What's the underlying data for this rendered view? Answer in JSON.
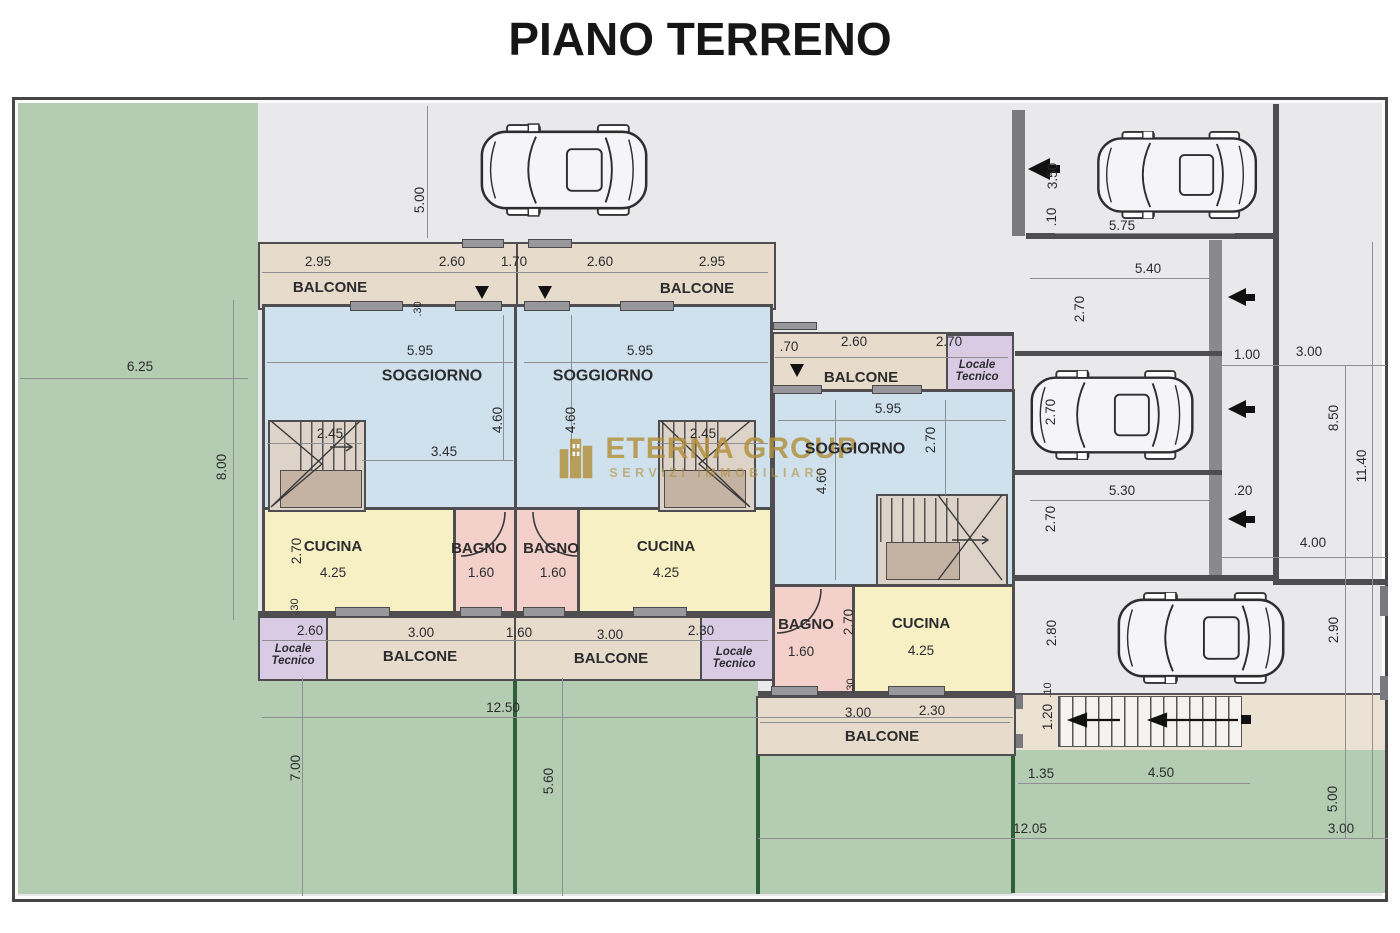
{
  "title": "PIANO TERRENO",
  "watermark": {
    "name": "ETERNA GROUP",
    "tagline": "SERVIZI IMMOBILIARI"
  },
  "colors": {
    "wall": "#4e4e50",
    "drive": "#e9e9ec",
    "garden": "#b3ccb2",
    "gardenDark": "#2f5e38",
    "soggiorno": "#cfe1ed",
    "cucina": "#f7f0c5",
    "bagno": "#f3d1ca",
    "balcone": "#e7dccb",
    "locale": "#d9cbe4",
    "stairs": "#ddd3c8",
    "landing": "#c4b3a3",
    "ramp": "#ece2d4",
    "wm": "#b3903c"
  },
  "icons": {
    "car": "car-top-view-icon",
    "entrance_arrow": "arrow-left-icon",
    "door_arrow": "arrow-down-icon",
    "logo": "buildings-logo-icon"
  },
  "labels": [
    {
      "t": "5.00",
      "x": 420,
      "y": 200,
      "r": 1
    },
    {
      "t": "2.95",
      "x": 318,
      "y": 262
    },
    {
      "t": "2.60",
      "x": 452,
      "y": 262
    },
    {
      "t": "1.70",
      "x": 514,
      "y": 262
    },
    {
      "t": "2.60",
      "x": 600,
      "y": 262
    },
    {
      "t": "2.95",
      "x": 712,
      "y": 262
    },
    {
      "t": "BALCONE",
      "x": 330,
      "y": 288,
      "b": 1,
      "s": 15
    },
    {
      "t": "BALCONE",
      "x": 697,
      "y": 289,
      "b": 1,
      "s": 15
    },
    {
      "t": ".30",
      "x": 419,
      "y": 309,
      "r": 1,
      "s": 11
    },
    {
      "t": "5.95",
      "x": 420,
      "y": 351
    },
    {
      "t": "SOGGIORNO",
      "x": 432,
      "y": 377,
      "b": 1,
      "s": 16
    },
    {
      "t": "2.45",
      "x": 330,
      "y": 434
    },
    {
      "t": "4.60",
      "x": 498,
      "y": 420,
      "r": 1
    },
    {
      "t": "3.45",
      "x": 444,
      "y": 452
    },
    {
      "t": "5.95",
      "x": 640,
      "y": 351
    },
    {
      "t": "SOGGIORNO",
      "x": 603,
      "y": 377,
      "b": 1,
      "s": 16
    },
    {
      "t": "2.45",
      "x": 703,
      "y": 434
    },
    {
      "t": "4.60",
      "x": 571,
      "y": 420,
      "r": 1
    },
    {
      "t": "2.70",
      "x": 297,
      "y": 551,
      "r": 1
    },
    {
      "t": "CUCINA",
      "x": 333,
      "y": 547,
      "b": 1,
      "s": 15
    },
    {
      "t": "4.25",
      "x": 333,
      "y": 573
    },
    {
      "t": "BAGNO",
      "x": 479,
      "y": 549,
      "b": 1,
      "s": 15
    },
    {
      "t": "1.60",
      "x": 481,
      "y": 573
    },
    {
      "t": "BAGNO",
      "x": 551,
      "y": 549,
      "b": 1,
      "s": 15
    },
    {
      "t": "1.60",
      "x": 553,
      "y": 573
    },
    {
      "t": "CUCINA",
      "x": 666,
      "y": 547,
      "b": 1,
      "s": 15
    },
    {
      "t": "4.25",
      "x": 666,
      "y": 573
    },
    {
      "t": ".30",
      "x": 296,
      "y": 606,
      "r": 1,
      "s": 11
    },
    {
      "t": "2.60",
      "x": 310,
      "y": 631
    },
    {
      "t": "3.00",
      "x": 421,
      "y": 633
    },
    {
      "t": "1.60",
      "x": 519,
      "y": 633
    },
    {
      "t": "3.00",
      "x": 610,
      "y": 635
    },
    {
      "t": "2.30",
      "x": 701,
      "y": 631
    },
    {
      "t": "Locale\nTecnico",
      "x": 293,
      "y": 655,
      "i": 1,
      "b": 1,
      "s": 11.5
    },
    {
      "t": "BALCONE",
      "x": 420,
      "y": 657,
      "b": 1,
      "s": 15
    },
    {
      "t": "BALCONE",
      "x": 611,
      "y": 659,
      "b": 1,
      "s": 15
    },
    {
      "t": "Locale\nTecnico",
      "x": 734,
      "y": 658,
      "i": 1,
      "b": 1,
      "s": 11.5
    },
    {
      "t": "12.50",
      "x": 503,
      "y": 708
    },
    {
      "t": "6.25",
      "x": 140,
      "y": 367
    },
    {
      "t": "8.00",
      "x": 222,
      "y": 467,
      "r": 1
    },
    {
      "t": "7.00",
      "x": 296,
      "y": 768,
      "r": 1
    },
    {
      "t": "5.60",
      "x": 549,
      "y": 781,
      "r": 1
    },
    {
      "t": ".70",
      "x": 789,
      "y": 347
    },
    {
      "t": "2.60",
      "x": 854,
      "y": 342
    },
    {
      "t": "2.70",
      "x": 949,
      "y": 342
    },
    {
      "t": "BALCONE",
      "x": 861,
      "y": 378,
      "b": 1,
      "s": 15
    },
    {
      "t": "Locale\nTecnico",
      "x": 977,
      "y": 371,
      "i": 1,
      "b": 1,
      "s": 11.5
    },
    {
      "t": "5.95",
      "x": 888,
      "y": 409
    },
    {
      "t": "SOGGIORNO",
      "x": 855,
      "y": 450,
      "b": 1,
      "s": 16
    },
    {
      "t": "2.70",
      "x": 931,
      "y": 440,
      "r": 1
    },
    {
      "t": "4.60",
      "x": 822,
      "y": 481,
      "r": 1
    },
    {
      "t": "BAGNO",
      "x": 806,
      "y": 625,
      "b": 1,
      "s": 15
    },
    {
      "t": "1.60",
      "x": 801,
      "y": 652
    },
    {
      "t": "2.70",
      "x": 849,
      "y": 622,
      "r": 1
    },
    {
      "t": "CUCINA",
      "x": 921,
      "y": 624,
      "b": 1,
      "s": 15
    },
    {
      "t": "4.25",
      "x": 921,
      "y": 651
    },
    {
      "t": ".30",
      "x": 852,
      "y": 686,
      "r": 1,
      "s": 11
    },
    {
      "t": "3.00",
      "x": 858,
      "y": 713
    },
    {
      "t": "2.30",
      "x": 932,
      "y": 711
    },
    {
      "t": "BALCONE",
      "x": 882,
      "y": 737,
      "b": 1,
      "s": 15
    },
    {
      "t": "3.50",
      "x": 1053,
      "y": 176,
      "r": 1
    },
    {
      "t": ".10",
      "x": 1052,
      "y": 217,
      "r": 1
    },
    {
      "t": "5.75",
      "x": 1122,
      "y": 226
    },
    {
      "t": "5.40",
      "x": 1148,
      "y": 269
    },
    {
      "t": "2.70",
      "x": 1080,
      "y": 309,
      "r": 1
    },
    {
      "t": "1.00",
      "x": 1247,
      "y": 355
    },
    {
      "t": "3.00",
      "x": 1309,
      "y": 352
    },
    {
      "t": "2.70",
      "x": 1051,
      "y": 412,
      "r": 1
    },
    {
      "t": "5.30",
      "x": 1122,
      "y": 491
    },
    {
      "t": ".20",
      "x": 1243,
      "y": 491
    },
    {
      "t": "2.70",
      "x": 1051,
      "y": 519,
      "r": 1
    },
    {
      "t": "8.50",
      "x": 1334,
      "y": 418,
      "r": 1
    },
    {
      "t": "11.40",
      "x": 1362,
      "y": 466,
      "r": 1
    },
    {
      "t": "4.00",
      "x": 1313,
      "y": 543
    },
    {
      "t": "2.80",
      "x": 1052,
      "y": 633,
      "r": 1
    },
    {
      "t": "2.90",
      "x": 1334,
      "y": 630,
      "r": 1
    },
    {
      "t": ".10",
      "x": 1049,
      "y": 690,
      "r": 1,
      "s": 11
    },
    {
      "t": "1.20",
      "x": 1048,
      "y": 717,
      "r": 1
    },
    {
      "t": "1.35",
      "x": 1041,
      "y": 774
    },
    {
      "t": "4.50",
      "x": 1161,
      "y": 773
    },
    {
      "t": "5.00",
      "x": 1333,
      "y": 799,
      "r": 1
    },
    {
      "t": "12.05",
      "x": 1030,
      "y": 829
    },
    {
      "t": "3.00",
      "x": 1341,
      "y": 829
    }
  ]
}
